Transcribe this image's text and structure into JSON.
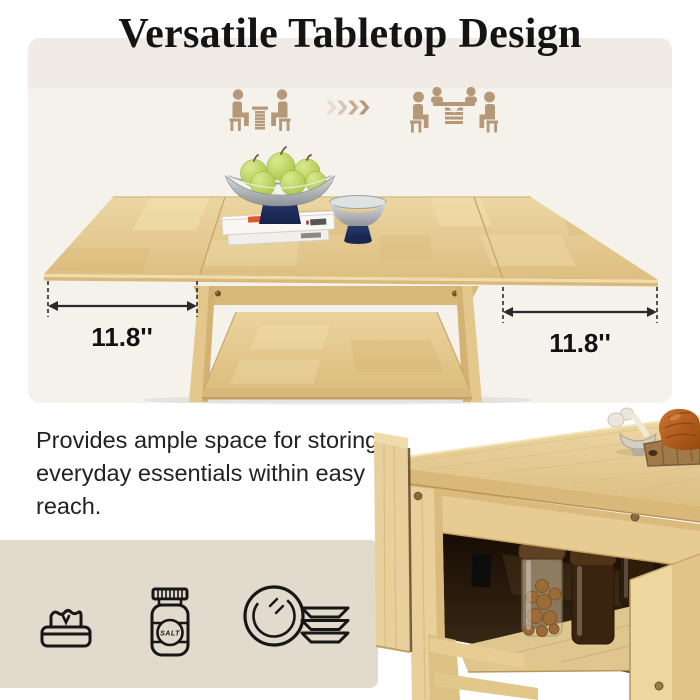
{
  "title": "Versatile Tabletop Design",
  "hero": {
    "dimension_left": "11.8''",
    "dimension_right": "11.8''",
    "capacity_icons": [
      "two-seater-table-icon",
      "arrow-chevrons-icon",
      "four-seater-table-icon"
    ],
    "colors": {
      "panel_top": "#f0ebe4",
      "panel_bottom": "#f5f2ec",
      "icon_tan": "#b49878",
      "wood_light": "#ecd6a3",
      "wood_dark": "#ddbe80",
      "navy_accent": "#1c2a57",
      "apple_green": "#b8d05e"
    }
  },
  "storage": {
    "description": "Provides ample space for storing everyday essentials within easy reach.",
    "panel_bg": "#e1dacd",
    "icons": [
      {
        "name": "napkin-box-icon"
      },
      {
        "name": "salt-jar-icon",
        "label": "SALT"
      },
      {
        "name": "dishes-icon"
      }
    ]
  }
}
